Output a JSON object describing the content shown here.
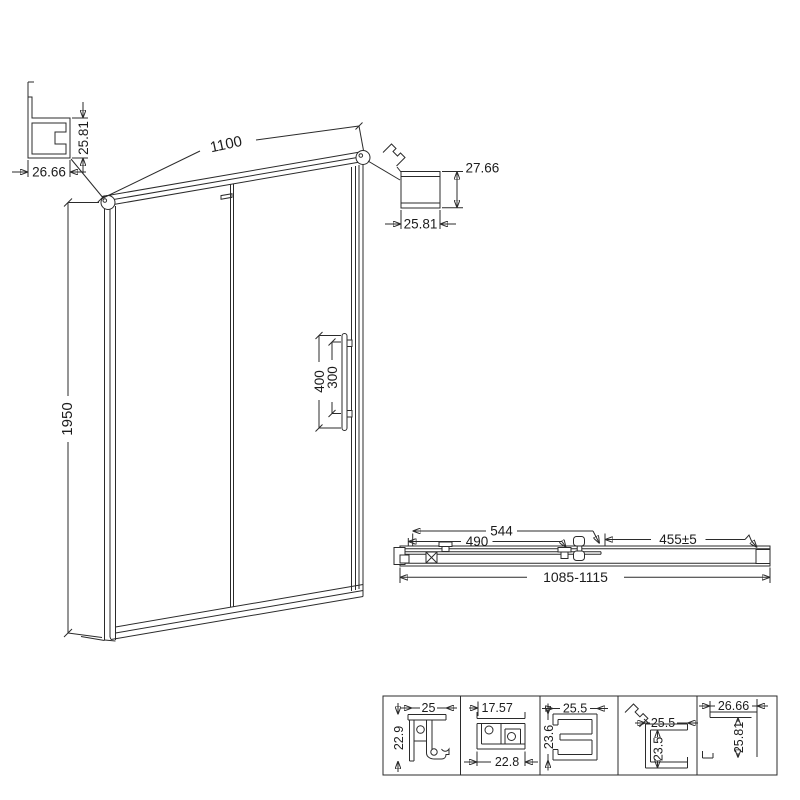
{
  "drawing": {
    "background": "#ffffff",
    "line_color": "#2b2b2b",
    "elevation": {
      "width": "1100",
      "height": "1950",
      "handle_length": "400",
      "handle_spacing": "300"
    },
    "top_left_profile": {
      "width": "26.66",
      "height": "25.81"
    },
    "top_right_profile": {
      "height": "27.66",
      "width": "25.81"
    },
    "plan": {
      "dim_a": "544",
      "dim_b": "490",
      "dim_c": "455±5",
      "overall": "1085-1115"
    },
    "details": [
      {
        "top": "25",
        "side": "22.9"
      },
      {
        "top": "17.57",
        "bottom": "22.8"
      },
      {
        "top": "25.5",
        "side": "23.6"
      },
      {
        "top": "25.5",
        "side": "23.5"
      },
      {
        "top": "26.66",
        "side": "25.81"
      }
    ]
  }
}
